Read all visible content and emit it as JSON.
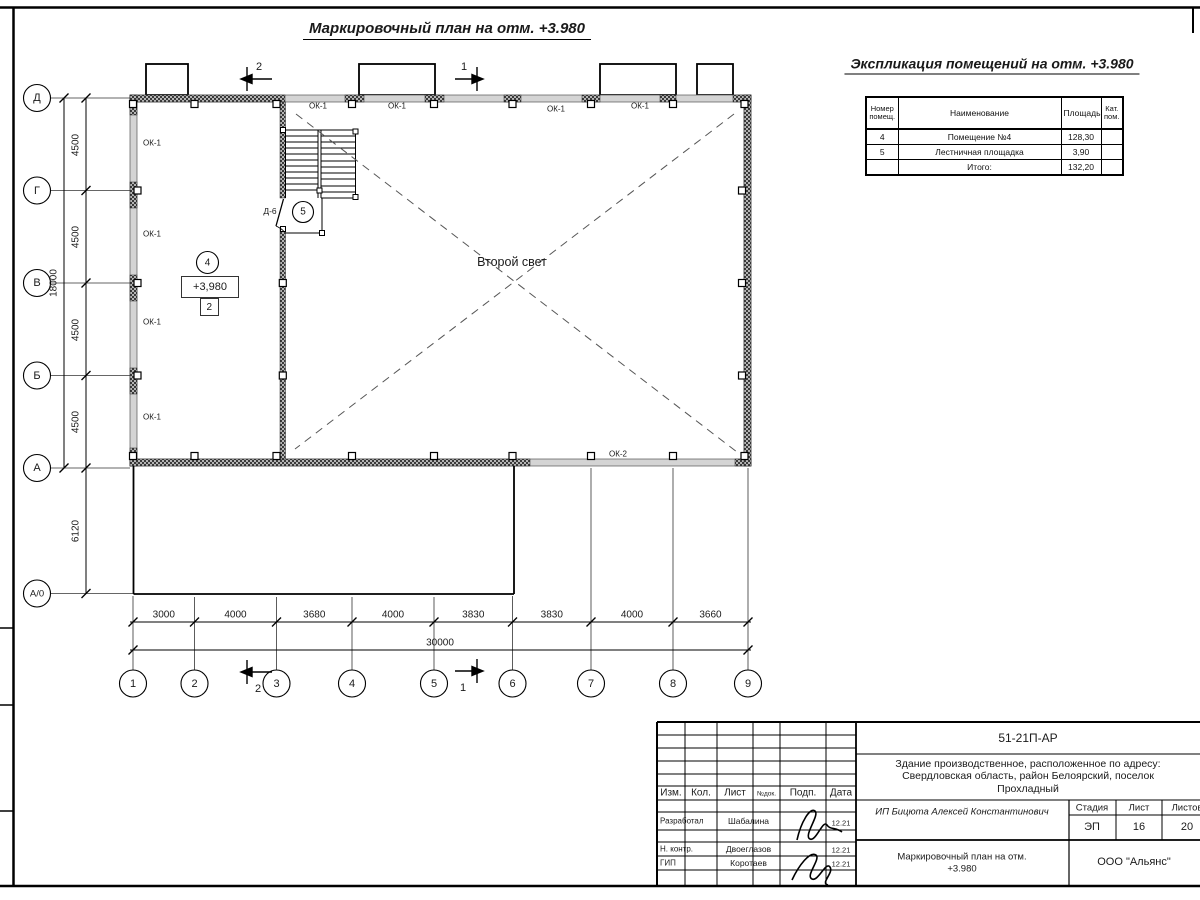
{
  "sheet": {
    "title": "Маркировочный план на отм. +3.980"
  },
  "axes": {
    "rows": [
      "Д",
      "Г",
      "В",
      "Б",
      "А",
      "А/0"
    ],
    "cols": [
      "1",
      "2",
      "3",
      "4",
      "5",
      "6",
      "7",
      "8",
      "9"
    ]
  },
  "dims": {
    "v": [
      "4500",
      "4500",
      "4500",
      "4500"
    ],
    "v_total": "18000",
    "v_lower": "6120",
    "h": [
      "3000",
      "4000",
      "3680",
      "4000",
      "3830",
      "3830",
      "4000",
      "3660"
    ],
    "h_total": "30000"
  },
  "plan": {
    "ok1": "ОК-1",
    "ok2": "ОК-2",
    "second_light": "Второй свет",
    "room4_tag": "4",
    "room5_tag": "5",
    "elevation": "+3,980",
    "zone": "2",
    "door": "Д-6"
  },
  "sections": {
    "one": "1",
    "two": "2"
  },
  "explication": {
    "title": "Экспликация помещений на отм. +3.980",
    "col_num": "Номер помещ.",
    "col_name": "Наименование",
    "col_area": "Площадь",
    "col_cat": "Кат. пом.",
    "rows": [
      {
        "num": "4",
        "name": "Помещение №4",
        "area": "128,30",
        "cat": ""
      },
      {
        "num": "5",
        "name": "Лестничная площадка",
        "area": "3,90",
        "cat": ""
      }
    ],
    "total_label": "Итого:",
    "total_area": "132,20"
  },
  "titleblock": {
    "doc_number": "51-21П-АР",
    "project_line1": "Здание производственное, расположенное по адресу:",
    "project_line2": "Свердловская область, район Белоярский, поселок",
    "project_line3": "Прохладный",
    "col_izm": "Изм.",
    "col_kol": "Кол.",
    "col_list": "Лист",
    "col_ndok": "№док.",
    "col_podp": "Подп.",
    "col_data": "Дата",
    "row1_role": "Разработал",
    "row1_name": "Шабалина",
    "row1_date": "12.21",
    "row2_role": "Н. контр.",
    "row2_name": "Двоеглазов",
    "row2_date": "12.21",
    "row3_role": "ГИП",
    "row3_name": "Коротаев",
    "row3_date": "12.21",
    "client": "ИП Бицюта Алексей Константинович",
    "stage_label": "Стадия",
    "sheet_label": "Лист",
    "sheets_label": "Листов",
    "stage": "ЭП",
    "sheet_no": "16",
    "sheets_total": "20",
    "drawing_name_line1": "Маркировочный план на отм.",
    "drawing_name_line2": "+3.980",
    "company": "ООО \"Альянс\""
  }
}
